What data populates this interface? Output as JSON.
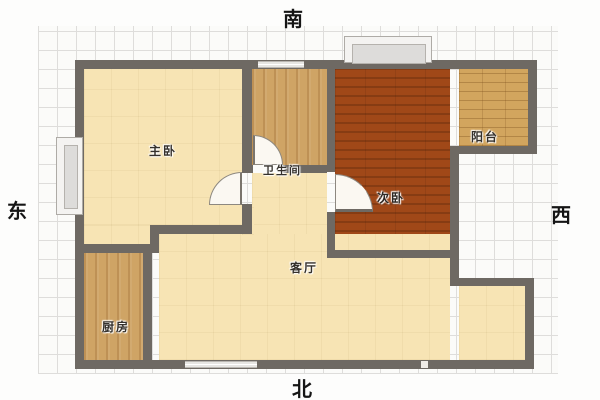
{
  "title": "apartment-floor-plan",
  "compass": {
    "south": "南",
    "north": "北",
    "east": "东",
    "west": "西"
  },
  "rooms": [
    {
      "name": "master-bedroom",
      "label": "主卧"
    },
    {
      "name": "bathroom",
      "label": "卫生间"
    },
    {
      "name": "second-bedroom",
      "label": "次卧"
    },
    {
      "name": "balcony",
      "label": "阳台"
    },
    {
      "name": "living-room",
      "label": "客厅"
    },
    {
      "name": "kitchen",
      "label": "厨房"
    }
  ],
  "features": {
    "doors": [
      "master-bedroom-door",
      "bathroom-door",
      "second-bedroom-door"
    ],
    "windows": [
      "top-bay-window",
      "left-bay-window",
      "top-wall-window",
      "bottom-wall-window"
    ],
    "entry_gap": "bottom-wall-entry-gap"
  },
  "colors": {
    "wall": "#6e6963",
    "floor_cream": "#f7e4b4",
    "floor_wood": "#cfa465",
    "floor_second_bedroom": "#a04818",
    "floor_balcony": "#d2a55e",
    "window_fill": "#dddcda",
    "grid_line": "#dedddb",
    "label_text": "#35312c"
  }
}
